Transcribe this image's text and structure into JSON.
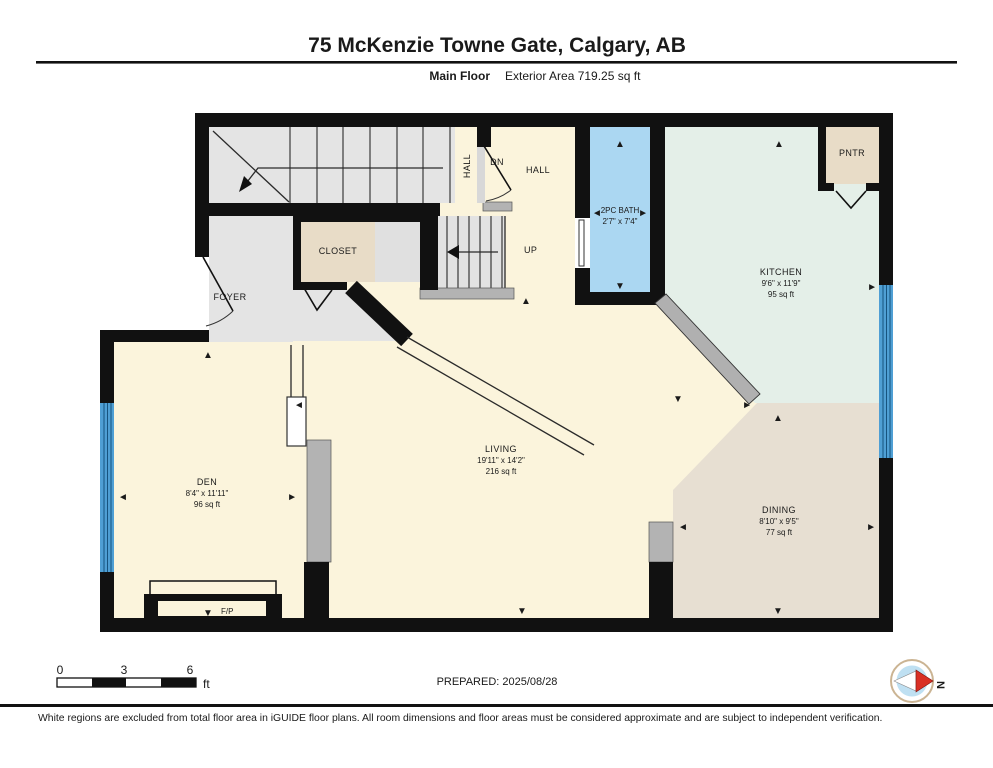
{
  "header": {
    "title": "75 McKenzie Towne Gate, Calgary, AB",
    "floor_label": "Main Floor",
    "area_label": "Exterior Area 719.25 sq ft"
  },
  "rooms": {
    "hall_side": {
      "label": "HALL"
    },
    "stairs_dn": {
      "label": "DN"
    },
    "hall": {
      "label": "HALL"
    },
    "stairs_up": {
      "label": "UP"
    },
    "closet": {
      "label": "CLOSET"
    },
    "foyer": {
      "label": "FOYER"
    },
    "bath": {
      "name": "2PC BATH",
      "dims": "2'7\" x 7'4\""
    },
    "pantry": {
      "label": "PNTR"
    },
    "kitchen": {
      "name": "KITCHEN",
      "dims": "9'6\" x 11'9\"",
      "area": "95 sq ft"
    },
    "living": {
      "name": "LIVING",
      "dims": "19'11\" x 14'2\"",
      "area": "216 sq ft"
    },
    "den": {
      "name": "DEN",
      "dims": "8'4\" x 11'11\"",
      "area": "96 sq ft"
    },
    "dining": {
      "name": "DINING",
      "dims": "8'10\" x 9'5\"",
      "area": "77 sq ft"
    },
    "fireplace": {
      "label": "F/P"
    }
  },
  "scale_bar": {
    "t0": "0",
    "t3": "3",
    "t6": "6",
    "unit": "ft"
  },
  "prepared": "PREPARED: 2025/08/28",
  "compass": {
    "label": "N"
  },
  "disclaimer": "White regions are excluded from total floor area in iGUIDE floor plans. All room dimensions and floor areas must be considered approximate and are subject to independent verification.",
  "colors": {
    "wall": "#111111",
    "floor_cream": "#fbf4dc",
    "floor_gray": "#e4e4e4",
    "floor_tan": "#e8dcc7",
    "floor_dining": "#e7dfd2",
    "floor_mint": "#e4efe8",
    "bath_blue": "#abd7f2",
    "window_blue": "#4f9fd4",
    "railing_gray": "#b3b3b3"
  }
}
